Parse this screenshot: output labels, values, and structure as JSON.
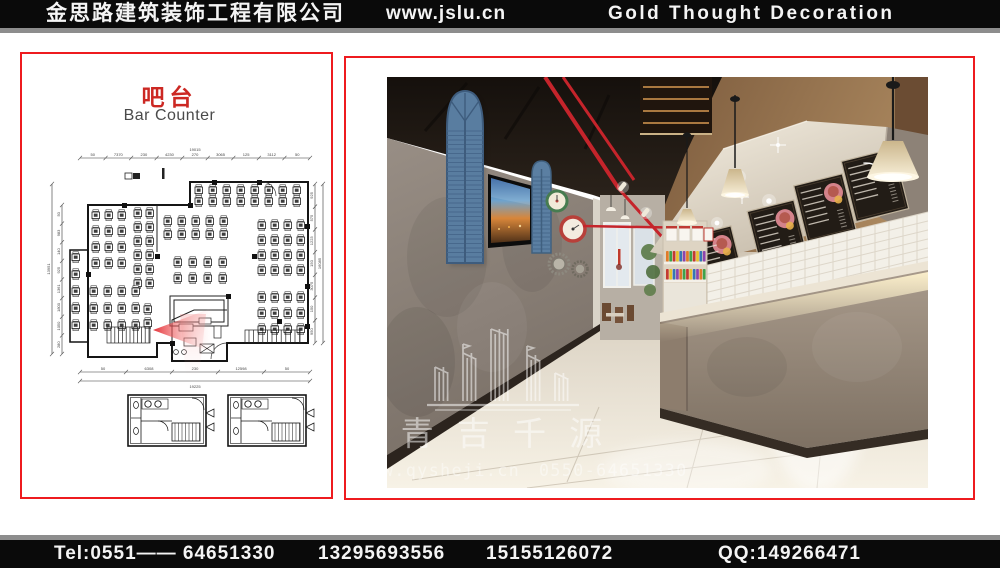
{
  "header": {
    "company_cn": "金思路建筑装饰工程有限公司",
    "website": "www.jslu.cn",
    "company_en": "Gold Thought Decoration"
  },
  "footer": {
    "tel": "Tel:0551—— 64651330",
    "phone1": "13295693556",
    "phone2": "15155126072",
    "qq": "QQ:149266471"
  },
  "plan_panel": {
    "title_cn": "吧台",
    "title_en": "Bar Counter",
    "dims": {
      "top": [
        "50",
        "7370",
        "230",
        "4230",
        "270",
        "3065",
        "125",
        "3112",
        "50"
      ],
      "top_overall": "19015",
      "bottom": [
        "50",
        "6308",
        "230",
        "12598",
        "50"
      ],
      "bottom_overall": "19225",
      "left": [
        "50",
        "983",
        "140",
        "925",
        "1361",
        "1800",
        "1050",
        "280"
      ],
      "left_overall": "13951",
      "right": [
        "925",
        "575",
        "1223",
        "150",
        "3075",
        "150",
        "950"
      ],
      "right_overall": "16085"
    }
  },
  "render_panel": {
    "watermark": {
      "name_cn": "青 吉 千 源",
      "url": "w.qysheji.cn",
      "phone": "0550-64651330"
    }
  },
  "colors": {
    "accent_red": "#ee1b1f",
    "title_red": "#cc2823",
    "bar_black": "#0a0a0a",
    "strip_gray": "#8d8d8d",
    "pipe_red": "#c5242b",
    "shutter_blue": "#597da0"
  }
}
